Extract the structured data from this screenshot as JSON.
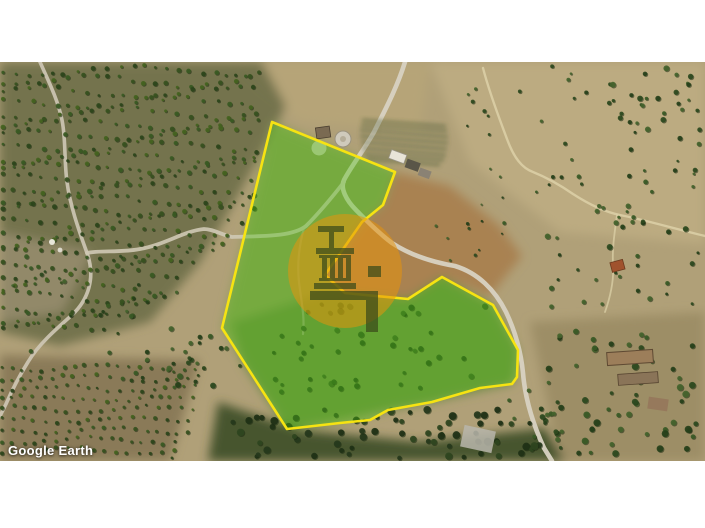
{
  "watermark": {
    "text": "Google Earth"
  },
  "map": {
    "type": "satellite-imagery",
    "parcel": {
      "label": "highlighted-land-parcel",
      "border_color": "#f6e312",
      "fill_color": "#4ec414",
      "fill_opacity": "0.38"
    },
    "badge": {
      "icon": "column-monument-logo",
      "circle_color": "#e6930d",
      "logo_color": "#3a4a1a"
    }
  }
}
